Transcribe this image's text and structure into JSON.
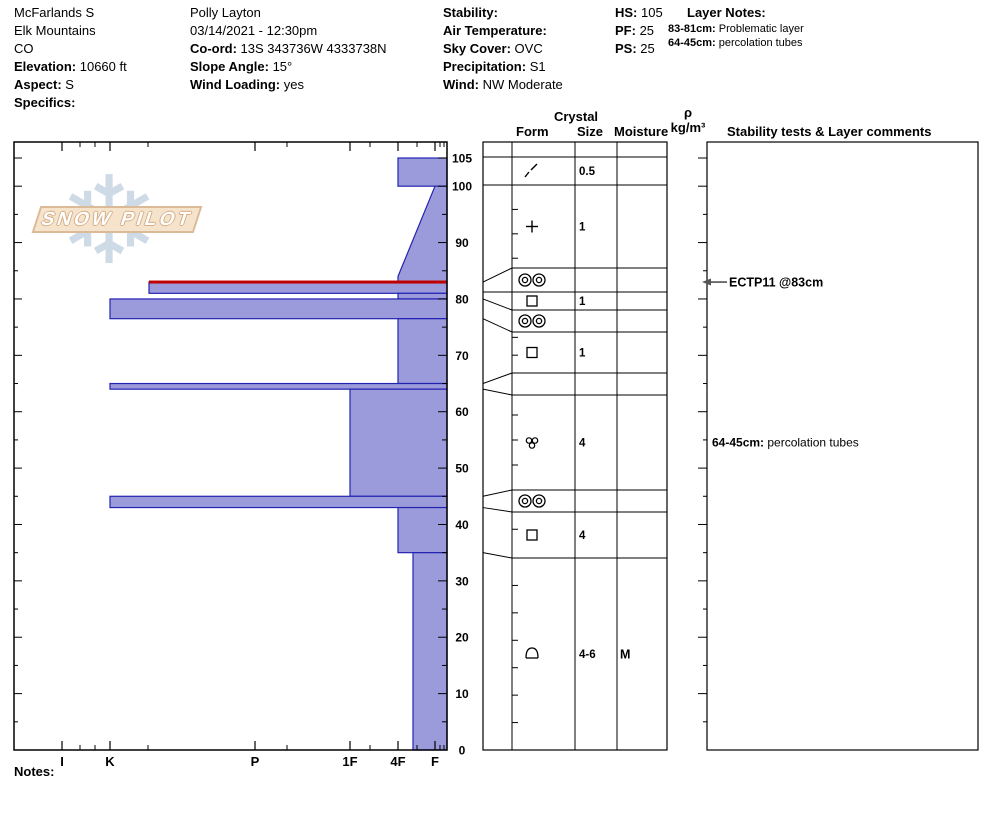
{
  "info_columns": [
    {
      "x": 14,
      "y": 4,
      "lines": [
        {
          "b": "",
          "t": "McFarlands S"
        },
        {
          "b": "",
          "t": "Elk Mountains"
        },
        {
          "b": "",
          "t": "CO"
        },
        {
          "b": "Elevation:",
          "t": " 10660 ft"
        },
        {
          "b": "Aspect:",
          "t": " S"
        },
        {
          "b": "Specifics:",
          "t": ""
        }
      ]
    },
    {
      "x": 190,
      "y": 4,
      "lines": [
        {
          "b": "",
          "t": "Polly Layton"
        },
        {
          "b": "",
          "t": "03/14/2021 - 12:30pm"
        },
        {
          "b": "Co-ord:",
          "t": " 13S 343736W 4333738N"
        },
        {
          "b": "Slope Angle:",
          "t": " 15°"
        },
        {
          "b": "Wind Loading:",
          "t": " yes"
        }
      ]
    },
    {
      "x": 443,
      "y": 4,
      "lines": [
        {
          "b": "Stability:",
          "t": ""
        },
        {
          "b": "Air Temperature:",
          "t": ""
        },
        {
          "b": "Sky Cover:",
          "t": " OVC"
        },
        {
          "b": "Precipitation:",
          "t": " S1"
        },
        {
          "b": "Wind:",
          "t": "  NW Moderate"
        }
      ]
    },
    {
      "x": 615,
      "y": 4,
      "lines": [
        {
          "b": "HS:",
          "t": " 105"
        },
        {
          "b": "PF:",
          "t": " 25"
        },
        {
          "b": "PS:",
          "t": " 25"
        }
      ]
    }
  ],
  "layer_notes": {
    "title": "Layer Notes:",
    "title_x": 687,
    "title_y": 4,
    "items_x": 668,
    "items_y": 22,
    "items": [
      {
        "b": "83-81cm:",
        "t": " Problematic layer"
      },
      {
        "b": "64-45cm:",
        "t": " percolation tubes"
      }
    ]
  },
  "table_headers": {
    "crystal": "Crystal",
    "form": "Form",
    "size": "Size",
    "moisture": "Moisture",
    "rho": "ρ",
    "rho_units": "kg/m³",
    "stability": "Stability tests & Layer comments"
  },
  "notes_label": "Notes:",
  "logo": {
    "text": "SNOW PILOT",
    "snowflake": "❄"
  },
  "chart_data": {
    "type": "bar",
    "title": "Snow hardness profile (SnowPilot)",
    "xlabel": "Hand hardness",
    "ylabel": "Depth (cm)",
    "x_categories": [
      "I",
      "K",
      "P",
      "1F",
      "4F",
      "F"
    ],
    "y_range": [
      0,
      105
    ],
    "depth_labels": [
      105,
      100,
      90,
      80,
      70,
      60,
      50,
      40,
      30,
      20,
      10,
      0
    ],
    "hardness_x": {
      "I": 62,
      "K": 110,
      "K-": 149,
      "P": 255,
      "1F": 350,
      "4F": 398,
      "4F-": 413,
      "F": 435
    },
    "x_minor_ticks": [
      80,
      95,
      148,
      287,
      370,
      417,
      440,
      444
    ],
    "plot": {
      "left": 14,
      "top": 142,
      "right": 447,
      "bottom": 750,
      "y_at_max_depth": 158
    },
    "layers": [
      {
        "depth_top": 105,
        "depth_bottom": 100,
        "hardness": "4F",
        "form": "DF",
        "size": "0.5",
        "moisture": ""
      },
      {
        "depth_top": 100,
        "depth_bottom": 83,
        "hardness": "4F",
        "hardness_top": "F",
        "slant_break_depth": 84,
        "form": "PP",
        "size": "1",
        "moisture": ""
      },
      {
        "depth_top": 83,
        "depth_bottom": 81,
        "hardness": "K-",
        "form": "MFcr",
        "size": "",
        "moisture": "",
        "flag": "red-top",
        "comment": "ECTP11 @83cm"
      },
      {
        "depth_top": 81,
        "depth_bottom": 80,
        "hardness": "4F",
        "form": "FC",
        "size": "1",
        "moisture": ""
      },
      {
        "depth_top": 80,
        "depth_bottom": 76.5,
        "hardness": "K",
        "form": "MFcr",
        "size": "",
        "moisture": ""
      },
      {
        "depth_top": 76.5,
        "depth_bottom": 65,
        "hardness": "4F",
        "form": "FC",
        "size": "1",
        "moisture": ""
      },
      {
        "depth_top": 65,
        "depth_bottom": 64,
        "hardness": "K",
        "form": "",
        "size": "",
        "moisture": ""
      },
      {
        "depth_top": 64,
        "depth_bottom": 45,
        "hardness": "1F",
        "form": "MFcl",
        "size": "4",
        "moisture": "",
        "comment": "64-45cm: percolation tubes"
      },
      {
        "depth_top": 45,
        "depth_bottom": 43,
        "hardness": "K",
        "form": "MFcr",
        "size": "",
        "moisture": ""
      },
      {
        "depth_top": 43,
        "depth_bottom": 35,
        "hardness": "4F",
        "form": "FC",
        "size": "4",
        "moisture": ""
      },
      {
        "depth_top": 35,
        "depth_bottom": 0,
        "hardness": "4F-",
        "form": "DH",
        "size": "4-6",
        "moisture": "M"
      }
    ],
    "table": {
      "left": 483,
      "form_left": 512,
      "size_left": 575,
      "moist_left": 617,
      "right": 667,
      "rho_right": 707,
      "row_bounds_px": [
        157,
        185,
        268,
        292,
        310,
        332,
        373,
        395,
        490,
        512,
        558,
        750
      ]
    },
    "comments_box": {
      "left": 707,
      "right": 978
    },
    "annotations": [
      {
        "kind": "arrow-comment",
        "text": "ECTP11 @83cm",
        "depth": 83
      },
      {
        "kind": "layer-comment",
        "bold": "64-45cm:",
        "text": " percolation tubes",
        "row": 7
      }
    ],
    "colors": {
      "bar_fill": "#9b9bdc",
      "bar_stroke": "#2323b0",
      "flag_red": "#c00000",
      "line": "#000000"
    }
  }
}
